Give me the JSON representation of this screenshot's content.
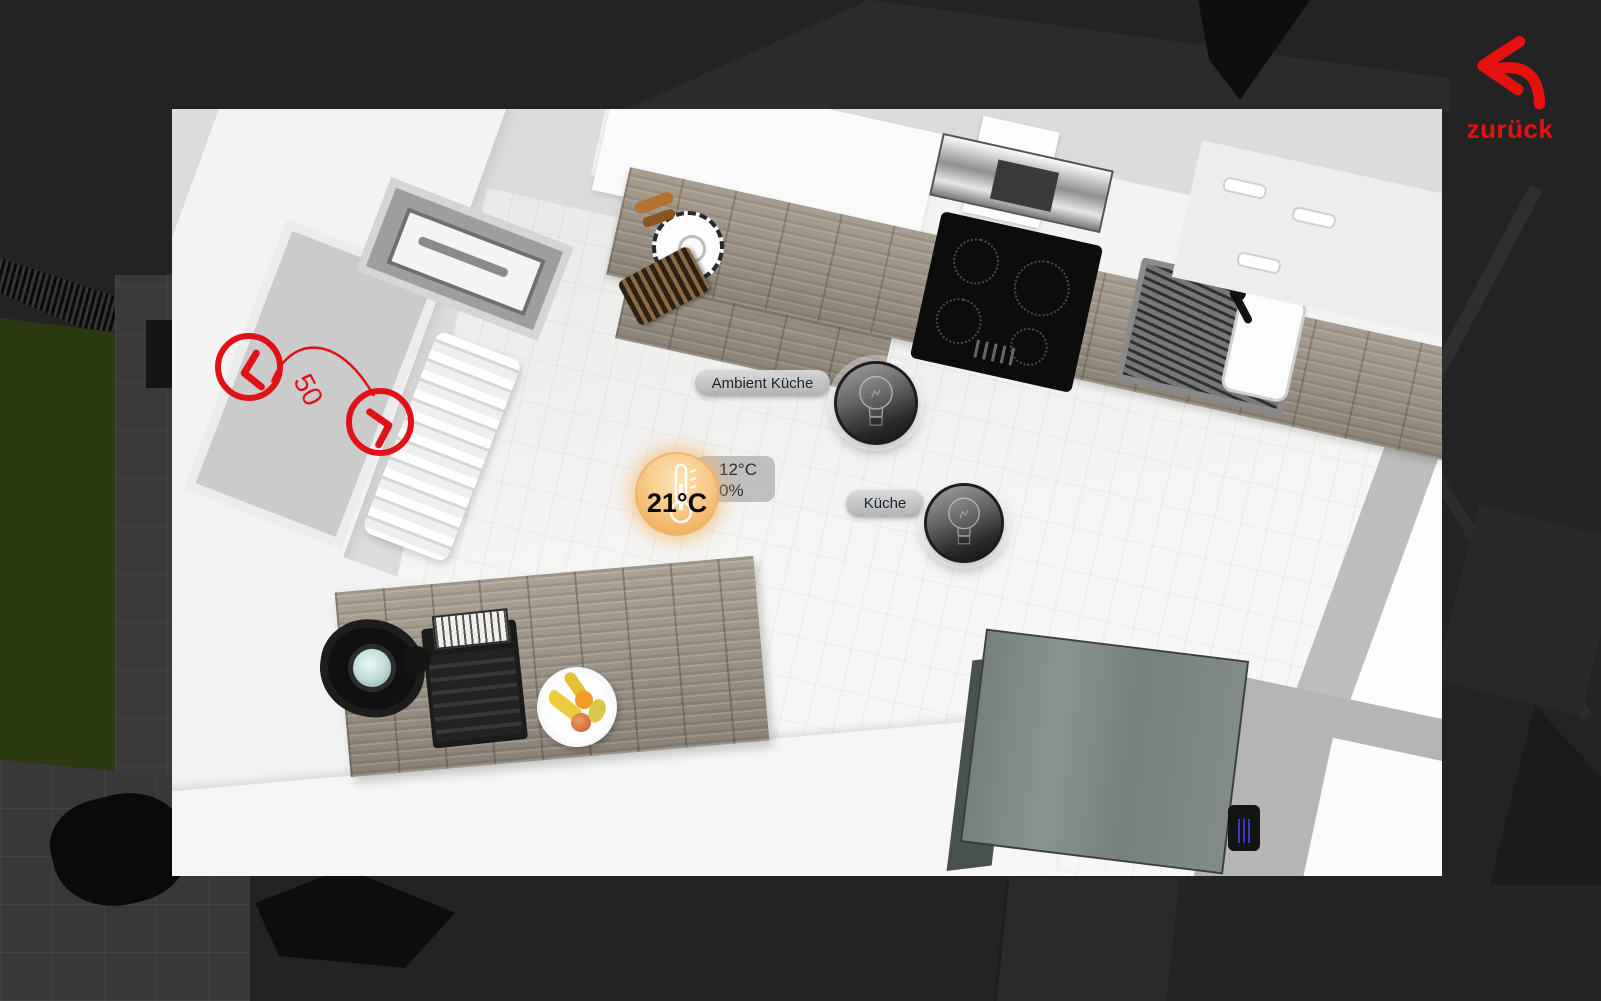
{
  "back_button": {
    "label": "zurück"
  },
  "shutter_control": {
    "position_value": "50"
  },
  "thermostat": {
    "current_temperature": "21°C",
    "tooltip": {
      "target_temperature": "12°C",
      "valve_percent": "0%"
    }
  },
  "lights": [
    {
      "label": "Ambient Küche"
    },
    {
      "label": "Küche"
    }
  ],
  "colors": {
    "background": "#232323",
    "accent_red": "#e01217",
    "thermostat_orange": "#eda44d",
    "overlay_pill": "#bdbdbd"
  }
}
